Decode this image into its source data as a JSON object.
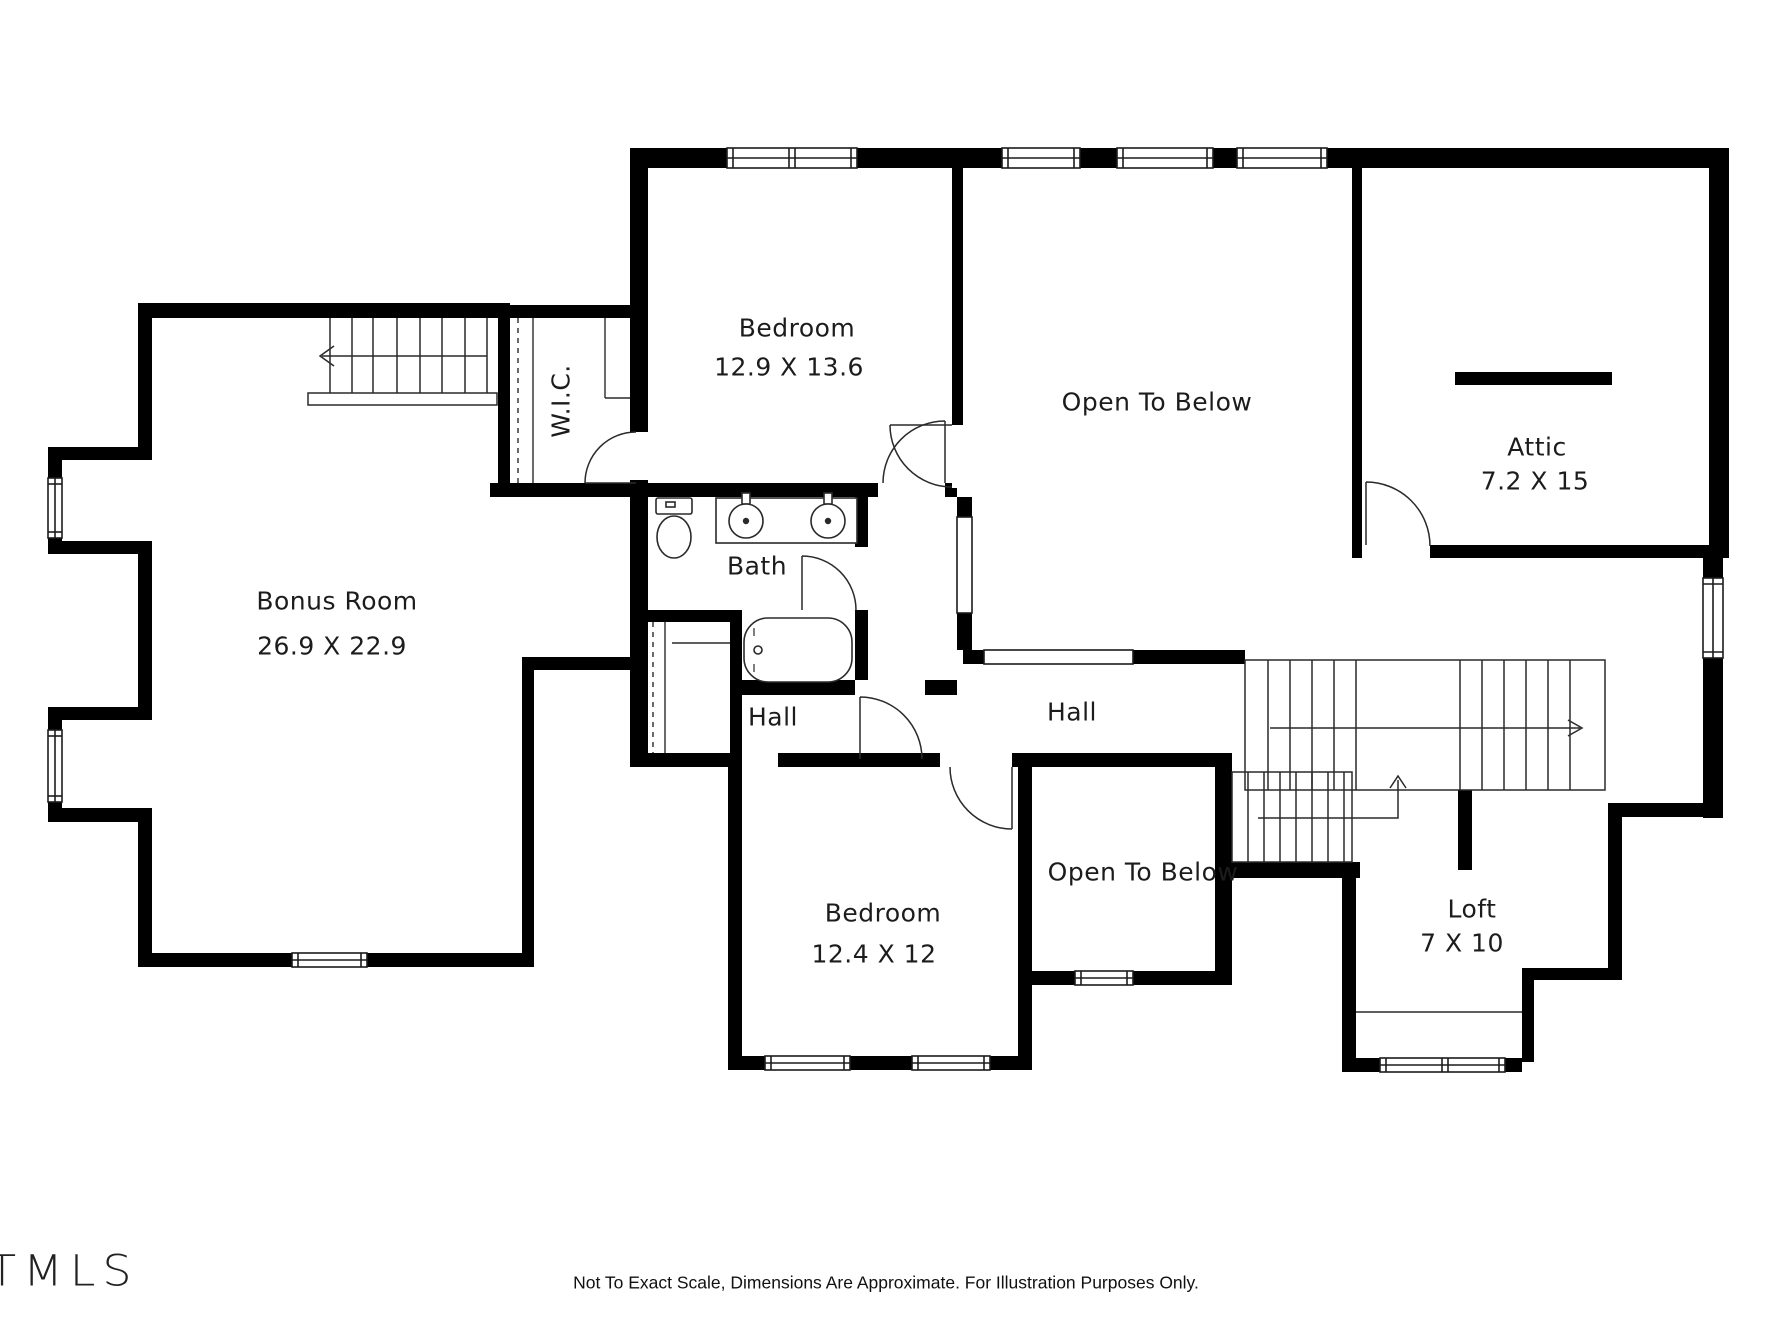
{
  "title": "Second floor plan",
  "rooms": [
    {
      "id": "bedroom-top",
      "label": "Bedroom",
      "dims": "12.9 X 13.6"
    },
    {
      "id": "open-to-below-top",
      "label": "Open To Below",
      "dims": ""
    },
    {
      "id": "attic",
      "label": "Attic",
      "dims": "7.2 X 15"
    },
    {
      "id": "bonus-room",
      "label": "Bonus Room",
      "dims": "26.9 X 22.9"
    },
    {
      "id": "wic",
      "label": "W.I.C.",
      "dims": ""
    },
    {
      "id": "bath",
      "label": "Bath",
      "dims": ""
    },
    {
      "id": "hall-small",
      "label": "Hall",
      "dims": ""
    },
    {
      "id": "hall-main",
      "label": "Hall",
      "dims": ""
    },
    {
      "id": "bedroom-bottom",
      "label": "Bedroom",
      "dims": "12.4 X 12"
    },
    {
      "id": "open-to-below-bottom",
      "label": "Open To Below",
      "dims": ""
    },
    {
      "id": "loft",
      "label": "Loft",
      "dims": "7 X 10"
    }
  ],
  "footer": {
    "disclaimer": "Not To Exact Scale, Dimensions Are Approximate. For Illustration Purposes Only."
  },
  "branding": {
    "logo_text": "TMLS"
  },
  "colors": {
    "wall": "#000000",
    "text": "#1c1c1c",
    "background": "#ffffff"
  }
}
